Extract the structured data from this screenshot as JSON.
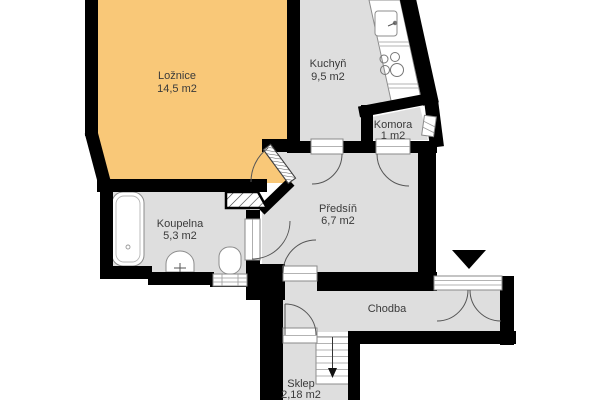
{
  "plan": {
    "title": "Apartment floor plan",
    "rooms": {
      "loznice": {
        "name": "Ložnice",
        "area": "14,5 m2"
      },
      "kuchyn": {
        "name": "Kuchyň",
        "area": "9,5 m2"
      },
      "komora": {
        "name": "Komora",
        "area": "1 m2"
      },
      "predsin": {
        "name": "Předsíň",
        "area": "6,7 m2"
      },
      "koupelna": {
        "name": "Koupelna",
        "area": "5,3 m2"
      },
      "chodba": {
        "name": "Chodba"
      },
      "sklep": {
        "name": "Sklep",
        "area": "2,18 m2"
      }
    },
    "colors": {
      "bedroom_fill": "#F9C878",
      "room_fill": "#DEDEDE",
      "wall": "#000000",
      "background": "#FFFFFF"
    },
    "markers": {
      "entrance": "entrance-arrow"
    }
  }
}
